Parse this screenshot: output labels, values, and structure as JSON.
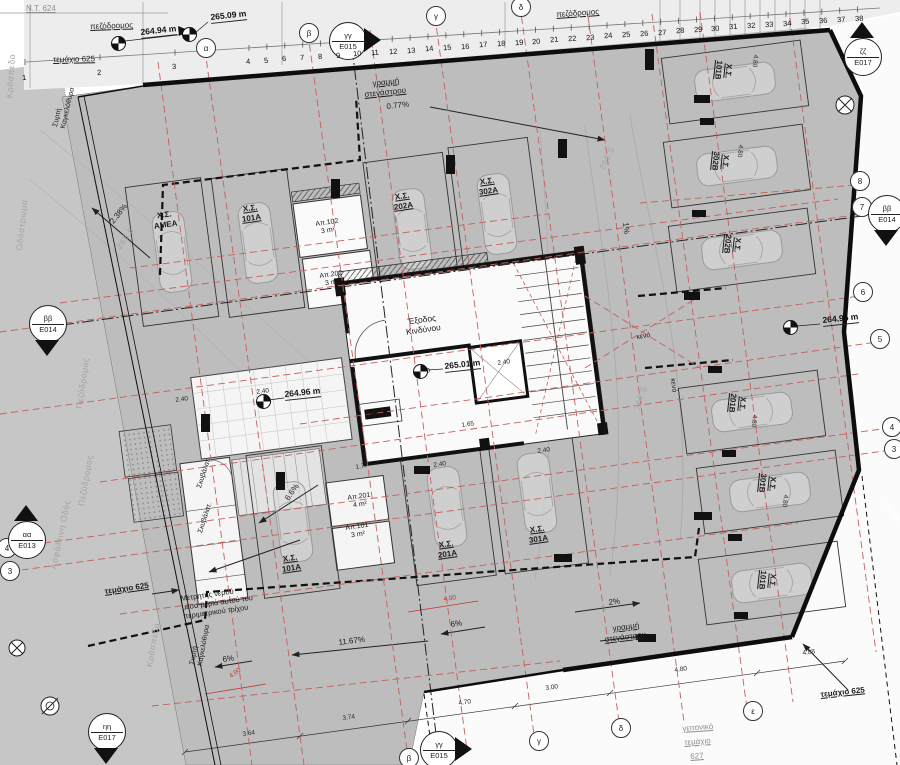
{
  "title": "ground floor parking plan",
  "colors": {
    "parcel": "#bdbdbd",
    "street": "#c6c6c6",
    "strip": "#ededed",
    "white_zone": "#fbfbfb",
    "wall": "#111111",
    "red_grid": "#c5605c",
    "red_dim": "#c0392b",
    "faint": "#a3a3a3"
  },
  "ruler": {
    "numbers": [
      "1",
      "2",
      "3",
      "4",
      "5",
      "6",
      "7",
      "8",
      "9",
      "10",
      "11",
      "12",
      "13",
      "14",
      "15",
      "16",
      "17",
      "18",
      "19",
      "20",
      "21",
      "22",
      "23",
      "24",
      "25",
      "26",
      "27",
      "28",
      "29",
      "30",
      "31",
      "32",
      "33",
      "34",
      "35",
      "36",
      "37",
      "38"
    ],
    "first_xs": [
      25,
      100,
      175
    ],
    "start_x": 249,
    "step": 17.9,
    "x0": 25,
    "y0": 83,
    "slope": -0.0714
  },
  "grid_bubbles": [
    {
      "n": "axis-bubble-alpha-top",
      "t": "α",
      "x": 205,
      "y": 47
    },
    {
      "n": "axis-bubble-beta-top",
      "t": "β",
      "x": 308,
      "y": 32
    },
    {
      "n": "axis-bubble-gamma-top",
      "t": "γ",
      "x": 435,
      "y": 15
    },
    {
      "n": "axis-bubble-delta-top",
      "t": "δ",
      "x": 520,
      "y": 6
    },
    {
      "n": "axis-bubble-beta-bottom",
      "t": "β",
      "x": 408,
      "y": 757
    },
    {
      "n": "axis-bubble-gamma-bottom",
      "t": "γ",
      "x": 538,
      "y": 740
    },
    {
      "n": "axis-bubble-delta-bottom",
      "t": "δ",
      "x": 620,
      "y": 727
    },
    {
      "n": "axis-bubble-epsilon-bottom",
      "t": "ε",
      "x": 752,
      "y": 710
    },
    {
      "n": "axis-bubble-8",
      "t": "8",
      "x": 859,
      "y": 180
    },
    {
      "n": "axis-bubble-7",
      "t": "7",
      "x": 861,
      "y": 206
    },
    {
      "n": "axis-bubble-6",
      "t": "6",
      "x": 862,
      "y": 291
    },
    {
      "n": "axis-bubble-5",
      "t": "5",
      "x": 879,
      "y": 338
    },
    {
      "n": "axis-bubble-4-right",
      "t": "4",
      "x": 891,
      "y": 426
    },
    {
      "n": "axis-bubble-3-right",
      "t": "3",
      "x": 893,
      "y": 448
    },
    {
      "n": "axis-bubble-4-left",
      "t": "4",
      "x": 6,
      "y": 547
    },
    {
      "n": "axis-bubble-3-left",
      "t": "3",
      "x": 9,
      "y": 570
    }
  ],
  "section_markers": [
    {
      "n": "section-marker-gg-top",
      "top": "γγ",
      "bottom": "E015",
      "x": 347,
      "y": 40,
      "tri": "right"
    },
    {
      "n": "section-marker-zz",
      "top": "ζζ",
      "bottom": "E017",
      "x": 862,
      "y": 56,
      "tri": "up"
    },
    {
      "n": "section-marker-bb-left",
      "top": "ββ",
      "bottom": "E014",
      "x": 47,
      "y": 323,
      "tri": "down"
    },
    {
      "n": "section-marker-bb-right",
      "top": "ββ",
      "bottom": "E014",
      "x": 886,
      "y": 213,
      "tri": "down"
    },
    {
      "n": "section-marker-aa",
      "top": "αα",
      "bottom": "E013",
      "x": 26,
      "y": 539,
      "tri": "up"
    },
    {
      "n": "section-marker-hh",
      "top": "ηη",
      "bottom": "E017",
      "x": 106,
      "y": 731,
      "tri": "down"
    },
    {
      "n": "section-marker-gg-bottom",
      "top": "γγ",
      "bottom": "E015",
      "x": 438,
      "y": 749,
      "tri": "right"
    }
  ],
  "elevation_points": [
    {
      "n": "elevation-264-94",
      "text": "264.94 m",
      "tx": 140,
      "ty": 27,
      "mx": 118,
      "my": 43
    },
    {
      "n": "elevation-265-09",
      "text": "265.09 m",
      "tx": 210,
      "ty": 12,
      "mx": 189,
      "my": 34
    },
    {
      "n": "elevation-264-95",
      "text": "264.95 m",
      "tx": 822,
      "ty": 315,
      "mx": 790,
      "my": 327
    },
    {
      "n": "elevation-265-01",
      "text": "265.01 m",
      "tx": 444,
      "ty": 361,
      "mx": 420,
      "my": 371
    },
    {
      "n": "elevation-264-96",
      "text": "264.96 m",
      "tx": 284,
      "ty": 389,
      "mx": 263,
      "my": 401
    }
  ],
  "labels": [
    {
      "n": "plot-nt-624",
      "t": "Ν.Τ. 624",
      "x": 26,
      "y": 4,
      "r": 0,
      "c": "gray u n"
    },
    {
      "n": "street-pezodromos-topleft",
      "t": "πεζόδρομος",
      "x": 90,
      "y": 22,
      "r": -2,
      "c": "u n"
    },
    {
      "n": "plot-625-topleft",
      "t": "τεμάχιο 625",
      "x": 53,
      "y": 55,
      "r": -1,
      "c": "u n"
    },
    {
      "n": "street-pezodromos-topright",
      "t": "πεζόδρομος",
      "x": 556,
      "y": 10,
      "r": -4,
      "c": "u n"
    },
    {
      "n": "plot-625-left",
      "t": "τεμάχιο 625",
      "x": 104,
      "y": 587,
      "r": -8,
      "c": "u"
    },
    {
      "n": "plot-625-bottomright",
      "t": "τεμάχιο 625",
      "x": 820,
      "y": 690,
      "r": -6,
      "c": "u"
    },
    {
      "n": "plot-627-line1",
      "t": "γειτονικό",
      "x": 682,
      "y": 724,
      "r": -4,
      "c": "gray u n"
    },
    {
      "n": "plot-627-line2",
      "t": "τεμάχιο",
      "x": 684,
      "y": 738,
      "r": -4,
      "c": "gray u n"
    },
    {
      "n": "plot-627-line3",
      "t": "627",
      "x": 690,
      "y": 752,
      "r": -4,
      "c": "gray u n"
    },
    {
      "n": "street-kraspedo-top",
      "t": "Κράσπεδο",
      "x": 4,
      "y": 98,
      "r": -86,
      "c": "faint"
    },
    {
      "n": "street-odostroma",
      "t": "Οδόστρωμα",
      "x": 14,
      "y": 250,
      "r": -84,
      "c": "faint"
    },
    {
      "n": "street-pezodromos-left1",
      "t": "Πεζόδρομος",
      "x": 74,
      "y": 408,
      "r": -82,
      "c": "faint"
    },
    {
      "n": "street-pezodromos-left2",
      "t": "Πεζόδρομος",
      "x": 76,
      "y": 505,
      "r": -80,
      "c": "faint"
    },
    {
      "n": "street-asfaltini",
      "t": "Ασφάλτινη Οδός",
      "x": 48,
      "y": 568,
      "r": -78,
      "c": "faint"
    },
    {
      "n": "street-kraspedo-bottom",
      "t": "Κράσπεδο",
      "x": 144,
      "y": 666,
      "r": -80,
      "c": "faint"
    },
    {
      "n": "canopy-line-top-1",
      "t": "γραμμή",
      "x": 372,
      "y": 79,
      "r": -6,
      "c": "u n"
    },
    {
      "n": "canopy-line-top-2",
      "t": "στεγάστρου",
      "x": 364,
      "y": 90,
      "r": -6,
      "c": "u n"
    },
    {
      "n": "slope-077",
      "t": "0.77%",
      "x": 386,
      "y": 102,
      "r": -6,
      "c": "n"
    },
    {
      "n": "slope-238",
      "t": "2.38%",
      "x": 108,
      "y": 220,
      "r": -52,
      "c": "n"
    },
    {
      "n": "slope-1",
      "t": "1%",
      "x": 630,
      "y": 222,
      "r": 84,
      "c": "n"
    },
    {
      "n": "slope-1167",
      "t": "11.67%",
      "x": 338,
      "y": 638,
      "r": -7,
      "c": "n"
    },
    {
      "n": "slope-6-left",
      "t": "6%",
      "x": 222,
      "y": 655,
      "r": -7,
      "c": "n"
    },
    {
      "n": "slope-6-mid",
      "t": "6%",
      "x": 450,
      "y": 620,
      "r": -7,
      "c": "n"
    },
    {
      "n": "slope-66-ramp",
      "t": "6.6%",
      "x": 283,
      "y": 497,
      "r": -55,
      "c": "n"
    },
    {
      "n": "slope-2",
      "t": "2%",
      "x": 608,
      "y": 598,
      "r": -7,
      "c": "n"
    },
    {
      "n": "canopy-line-bottom-1",
      "t": "γραμμή",
      "x": 612,
      "y": 624,
      "r": -7,
      "c": "u n"
    },
    {
      "n": "canopy-line-bottom-2",
      "t": "στεγάστρου",
      "x": 604,
      "y": 635,
      "r": -7,
      "c": "u n"
    },
    {
      "n": "parking-amea",
      "t": "Χ.Σ.\nΑΜΕΑ",
      "x": 152,
      "y": 212,
      "r": -8,
      "c": "c"
    },
    {
      "n": "parking-101a-top",
      "t": "Χ.Σ.\n101Α",
      "x": 240,
      "y": 205,
      "r": -8,
      "c": "c u"
    },
    {
      "n": "parking-202a",
      "t": "Χ.Σ.\n202Α",
      "x": 392,
      "y": 193,
      "r": -8,
      "c": "c u"
    },
    {
      "n": "parking-302a",
      "t": "Χ.Σ.\n302Α",
      "x": 477,
      "y": 178,
      "r": -8,
      "c": "c u"
    },
    {
      "n": "parking-101a-bottom",
      "t": "Χ.Σ.\n101Α",
      "x": 280,
      "y": 555,
      "r": -8,
      "c": "c u"
    },
    {
      "n": "parking-201a",
      "t": "Χ.Σ.\n201Α",
      "x": 436,
      "y": 541,
      "r": -8,
      "c": "c u"
    },
    {
      "n": "parking-301a",
      "t": "Χ.Σ.\n301Α",
      "x": 527,
      "y": 526,
      "r": -8,
      "c": "c u"
    },
    {
      "n": "parking-101b-top",
      "t": "Χ.Σ.\n101Β",
      "x": 734,
      "y": 62,
      "r": 96,
      "c": "c u"
    },
    {
      "n": "parking-302b",
      "t": "Χ.Σ.\n302Β",
      "x": 731,
      "y": 153,
      "r": 96,
      "c": "c u"
    },
    {
      "n": "parking-202b",
      "t": "Χ.Σ.\n202Β",
      "x": 743,
      "y": 236,
      "r": 96,
      "c": "c u"
    },
    {
      "n": "parking-201b",
      "t": "Χ.Σ.\n201Β",
      "x": 748,
      "y": 395,
      "r": 96,
      "c": "c u"
    },
    {
      "n": "parking-301b",
      "t": "Χ.Σ.\n301Β",
      "x": 778,
      "y": 475,
      "r": 96,
      "c": "c u"
    },
    {
      "n": "parking-101b-bottom",
      "t": "Χ.Σ.\n101Β",
      "x": 778,
      "y": 572,
      "r": 96,
      "c": "c u"
    },
    {
      "n": "storage-ap102",
      "t": "Απ.102\n3 m²",
      "x": 315,
      "y": 221,
      "r": -8,
      "c": "sm c n"
    },
    {
      "n": "storage-ap202",
      "t": "Απ.202\n3 m²",
      "x": 319,
      "y": 273,
      "r": -8,
      "c": "sm c n"
    },
    {
      "n": "storage-ap201",
      "t": "Απ.201\n4 m²",
      "x": 347,
      "y": 495,
      "r": -8,
      "c": "sm c n"
    },
    {
      "n": "storage-ap101",
      "t": "Απ.101\n3 m²",
      "x": 345,
      "y": 525,
      "r": -8,
      "c": "sm c n"
    },
    {
      "n": "garbage-label-1",
      "t": "Σκυβάλατ.",
      "x": 196,
      "y": 487,
      "r": -72,
      "c": "sm n"
    },
    {
      "n": "garbage-label-2",
      "t": "Σκυβάλατ.",
      "x": 197,
      "y": 532,
      "r": -72,
      "c": "sm n"
    },
    {
      "n": "emergency-exit-label",
      "t": "Έξοδος\nΚινδύνου",
      "x": 404,
      "y": 317,
      "r": -8,
      "c": "rm c n"
    },
    {
      "n": "ahk-meter-label",
      "t": "ΑΗΚ",
      "x": 364,
      "y": 412,
      "r": -8,
      "c": "sm"
    },
    {
      "n": "void-label-1",
      "t": "κενό",
      "x": 636,
      "y": 334,
      "r": -8,
      "c": "sm n"
    },
    {
      "n": "void-label-2",
      "t": "κενό",
      "x": 676,
      "y": 378,
      "r": 84,
      "c": "sm n"
    },
    {
      "n": "water-meter-note",
      "t": "Μετρητής νερού\nμέσα μεριά αυτού του\nπεριμετρικού τοίχου",
      "x": 180,
      "y": 594,
      "r": -8,
      "c": "note"
    },
    {
      "n": "contour-266-5",
      "t": "266.5",
      "x": 597,
      "y": 167,
      "r": -64,
      "c": "faint"
    },
    {
      "n": "contour-267-5",
      "t": "267.5",
      "x": 632,
      "y": 408,
      "r": -72,
      "c": "faint"
    },
    {
      "n": "contour-265-5",
      "t": "265.5",
      "x": 114,
      "y": 245,
      "r": -55,
      "c": "faint"
    },
    {
      "n": "dim-3-64",
      "t": "3.64",
      "x": 242,
      "y": 731,
      "r": -8,
      "c": "dim"
    },
    {
      "n": "dim-3-74",
      "t": "3.74",
      "x": 342,
      "y": 715,
      "r": -8,
      "c": "dim"
    },
    {
      "n": "dim-4-70",
      "t": "4.70",
      "x": 458,
      "y": 700,
      "r": -8,
      "c": "dim"
    },
    {
      "n": "dim-3-00",
      "t": "3.00",
      "x": 545,
      "y": 685,
      "r": -8,
      "c": "dim"
    },
    {
      "n": "dim-4-80-bottom",
      "t": "4.80",
      "x": 674,
      "y": 667,
      "r": -8,
      "c": "dim"
    },
    {
      "n": "dim-4-88",
      "t": "4.88",
      "x": 802,
      "y": 650,
      "r": -8,
      "c": "dim"
    },
    {
      "n": "dim-2-40-a",
      "t": "2.40",
      "x": 175,
      "y": 397,
      "r": -8,
      "c": "dim"
    },
    {
      "n": "dim-2-40-b",
      "t": "2.40",
      "x": 256,
      "y": 389,
      "r": -8,
      "c": "dim"
    },
    {
      "n": "dim-2-40-c",
      "t": "2.40",
      "x": 417,
      "y": 369,
      "r": -8,
      "c": "dim"
    },
    {
      "n": "dim-2-40-d",
      "t": "2.40",
      "x": 497,
      "y": 360,
      "r": -8,
      "c": "dim"
    },
    {
      "n": "dim-2-40-e",
      "t": "2.40",
      "x": 433,
      "y": 462,
      "r": -8,
      "c": "dim"
    },
    {
      "n": "dim-2-40-f",
      "t": "2.40",
      "x": 537,
      "y": 448,
      "r": -8,
      "c": "dim"
    },
    {
      "n": "dim-1-77",
      "t": "1.77",
      "x": 355,
      "y": 464,
      "r": -8,
      "c": "dim"
    },
    {
      "n": "dim-1-65",
      "t": "1.65",
      "x": 461,
      "y": 422,
      "r": -8,
      "c": "dim"
    },
    {
      "n": "dim-4-80-r1",
      "t": "4.80",
      "x": 759,
      "y": 55,
      "r": 96,
      "c": "dim"
    },
    {
      "n": "dim-4-80-r2",
      "t": "4.80",
      "x": 744,
      "y": 145,
      "r": 96,
      "c": "dim"
    },
    {
      "n": "dim-4-80-r3",
      "t": "4.80",
      "x": 758,
      "y": 415,
      "r": 96,
      "c": "dim"
    },
    {
      "n": "dim-4-80-r4",
      "t": "4.80",
      "x": 789,
      "y": 495,
      "r": 96,
      "c": "dim"
    },
    {
      "n": "dim-4-00-red-left",
      "t": "4.00",
      "x": 228,
      "y": 674,
      "r": -35,
      "c": "dim red"
    },
    {
      "n": "dim-4-00-red-mid",
      "t": "4.00",
      "x": 443,
      "y": 596,
      "r": -8,
      "c": "dim red"
    },
    {
      "n": "gate-label-top",
      "t": "Συρτή\nΚαγκελόθυρα",
      "x": 52,
      "y": 126,
      "r": -77,
      "c": "sm n"
    },
    {
      "n": "gate-label-bottom",
      "t": "Συρτή\nΚαγκελόθυρα",
      "x": 189,
      "y": 664,
      "r": -80,
      "c": "sm n"
    }
  ]
}
